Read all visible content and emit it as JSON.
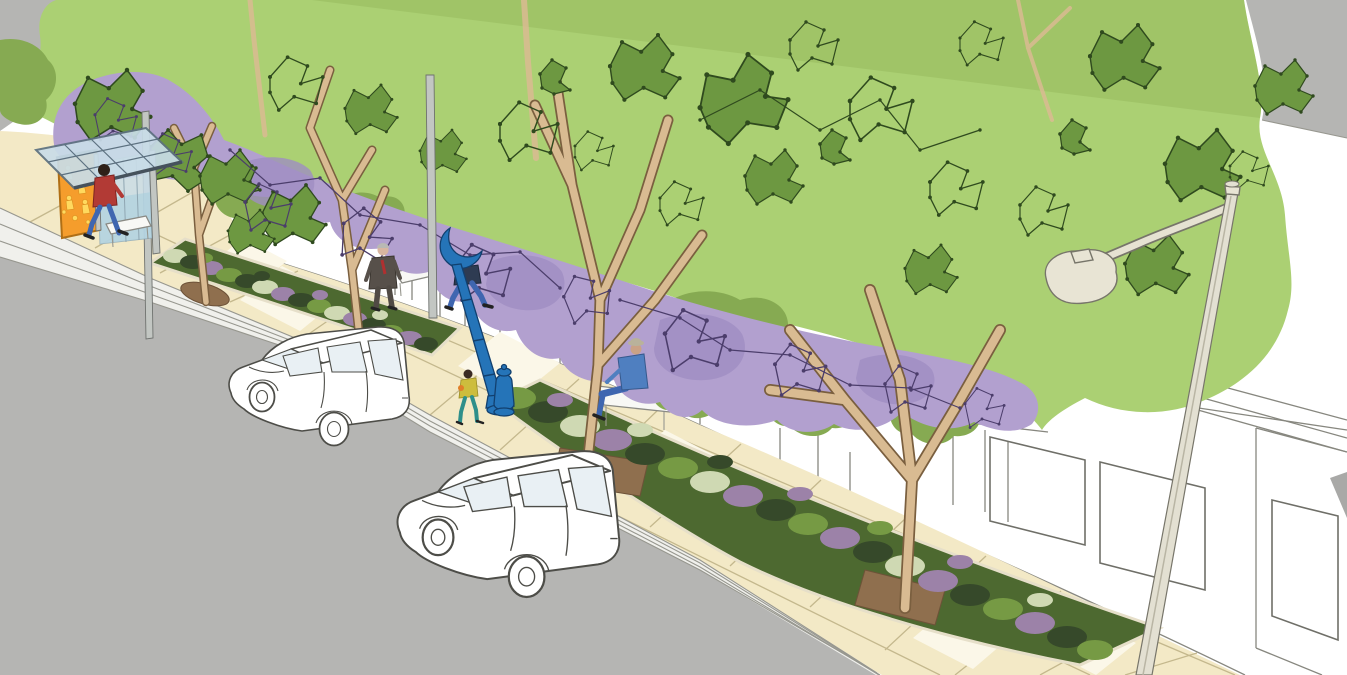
{
  "scene": {
    "type": "urban streetscape concept rendering",
    "description": "Sketch-style architectural rendering of a sidewalk: layered light-green and purple street-tree canopies with polygonal leaf clusters, tan tree trunks, paver sidewalk, two landscaped curbside planting strips, a glass bus shelter with an orange art panel, a decorative blue art pole and hydrant, a tall curved street lamp, white line-drawn parked cars on a gray road, a white storefront facade, and several pedestrians."
  },
  "colors": {
    "road_gray": "#b5b5b3",
    "dark_gray": "#a9a9a7",
    "sidewalk_cream": "#f3e9c6",
    "paver_line": "#c4b88d",
    "paver_white": "#fbf7e8",
    "curb_white": "#f0f0ec",
    "canopy_light_green": "#abd073",
    "canopy_mid_green": "#86aa52",
    "canopy_dark_green": "#6d9841",
    "leaf_outline": "#2f4a1e",
    "canopy_purple": "#b2a0cf",
    "canopy_purple_dark": "#9f8dc2",
    "purple_outline": "#4b3d6b",
    "trunk_tan": "#d9bb92",
    "trunk_outline": "#7a5f3f",
    "dirt_brown": "#8f6f4e",
    "bed_base": "#4d6930",
    "plant_dark": "#36492a",
    "plant_mid": "#769a44",
    "plant_sage": "#cfd9b3",
    "plant_purple": "#9c82a8",
    "stone_edge": "#e6dfc9",
    "shelter_orange": "#f59d2c",
    "art_yellow": "#ffd95e",
    "glass_blue": "#c9dde8",
    "pole_blue": "#2574b8",
    "lamp_cream": "#e8e4d4",
    "car_outline": "#4d4d48",
    "person_red": "#b23a35",
    "person_jeans": "#3f66b0",
    "person_suit": "#57504a",
    "person_shirt_blue": "#4f7fc0",
    "person_teal": "#2e8f8a",
    "person_yellow": "#cdbd3d"
  },
  "objects": {
    "bus_shelter": {
      "label": "bus shelter with sloped glass roof and orange art panel"
    },
    "street_lamp": {
      "label": "tall street light with curved arm"
    },
    "art_pole": {
      "label": "blue decorative art pole with crescent top"
    },
    "hydrant": {
      "label": "blue fire hydrant"
    },
    "cars": {
      "count": 2,
      "label": "white line-drawn station wagons parked at curb"
    },
    "trees": {
      "count": 4,
      "label": "street trees in planting strips"
    },
    "planting_beds": {
      "count": 2,
      "label": "landscaped curbside planting strips"
    },
    "benches": {
      "count": 3,
      "label": "white sidewalk benches"
    },
    "people": [
      {
        "label": "pedestrian in red jacket at bus shelter"
      },
      {
        "label": "man in dark suit with red tie walking"
      },
      {
        "label": "pedestrian in jeans behind art pole"
      },
      {
        "label": "child near hydrant"
      },
      {
        "label": "person seated on bench"
      }
    ]
  }
}
